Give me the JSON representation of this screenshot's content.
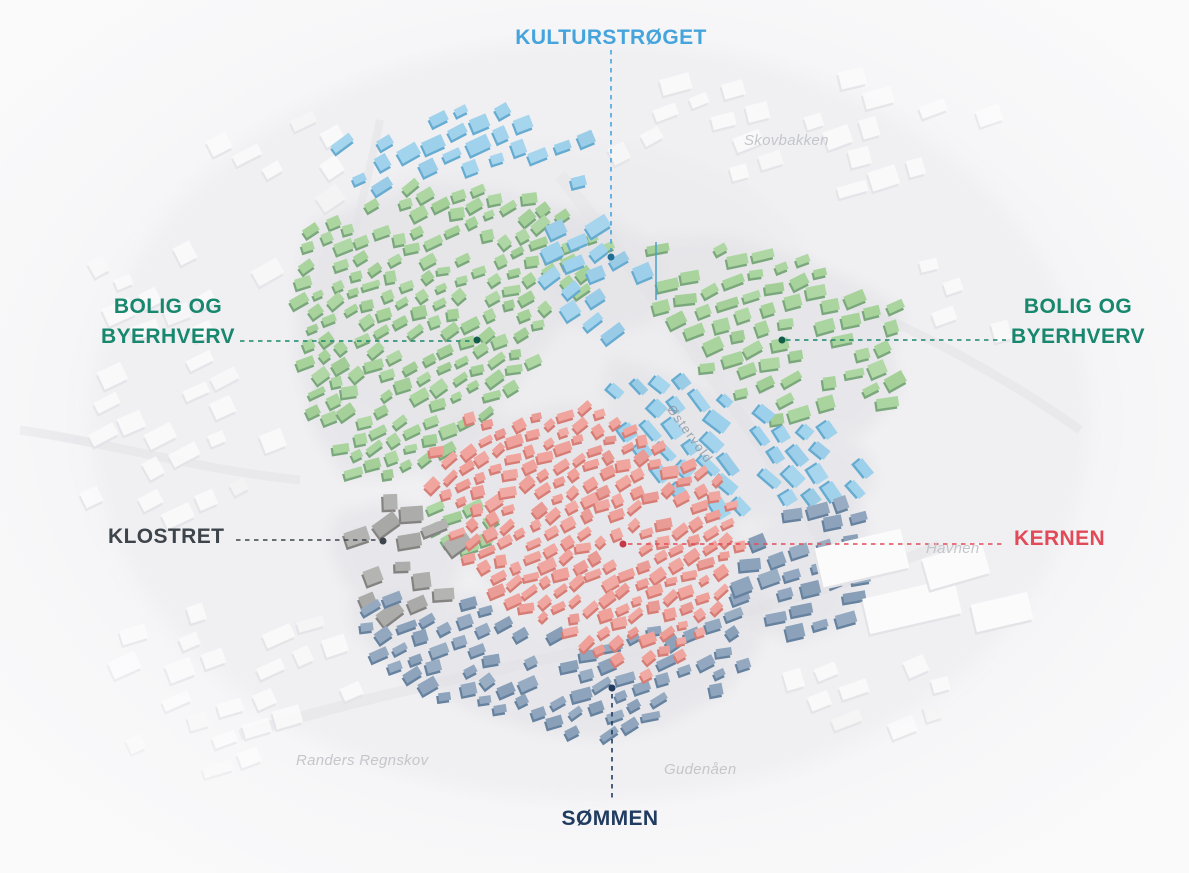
{
  "map": {
    "background": "#f5f5f7",
    "street": "#e8e8eb",
    "underlay": "#e1e1e5",
    "context_roof": "#fbfbfc",
    "context_side": "#e4e4e8",
    "vignette": "#fafafb",
    "spire_color": "#4aa0c8"
  },
  "districts": [
    {
      "id": "kulturstroget",
      "line1": "KULTURSTRØGET",
      "label_color": "#46a4dc",
      "roof": "#9ed1ec",
      "side": "#66abd0",
      "dot_color": "#1e6f93"
    },
    {
      "id": "bolig-byerhverv-vest",
      "line1": "BOLIG OG",
      "line2": "BYERHVERV",
      "label_color": "#17876d",
      "roof": "#a7d39b",
      "side": "#7aa87c",
      "dot_color": "#135c4a"
    },
    {
      "id": "bolig-byerhverv-ost",
      "line1": "BOLIG OG",
      "line2": "BYERHVERV",
      "label_color": "#17876d",
      "roof": "#a7d39b",
      "side": "#7aa87c",
      "dot_color": "#135c4a"
    },
    {
      "id": "klostret",
      "line1": "KLOSTRET",
      "label_color": "#3e444b",
      "roof": "#ababa9",
      "side": "#858381",
      "dot_color": "#3e444b"
    },
    {
      "id": "kernen",
      "line1": "KERNEN",
      "label_color": "#e24a58",
      "roof": "#efa099",
      "side": "#d67d76",
      "dot_color": "#c43847"
    },
    {
      "id": "sommen",
      "line1": "SØMMEN",
      "label_color": "#203c60",
      "roof": "#8da3bc",
      "side": "#66829f",
      "dot_color": "#203c60"
    }
  ],
  "background_labels": [
    {
      "id": "skovbakken",
      "text": "Skovbakken"
    },
    {
      "id": "havnen",
      "text": "Havnen"
    },
    {
      "id": "randers-regnskov",
      "text": "Randers Regnskov"
    },
    {
      "id": "gudenaen",
      "text": "Gudenåen"
    },
    {
      "id": "ostervold",
      "text": "Østervold"
    }
  ]
}
